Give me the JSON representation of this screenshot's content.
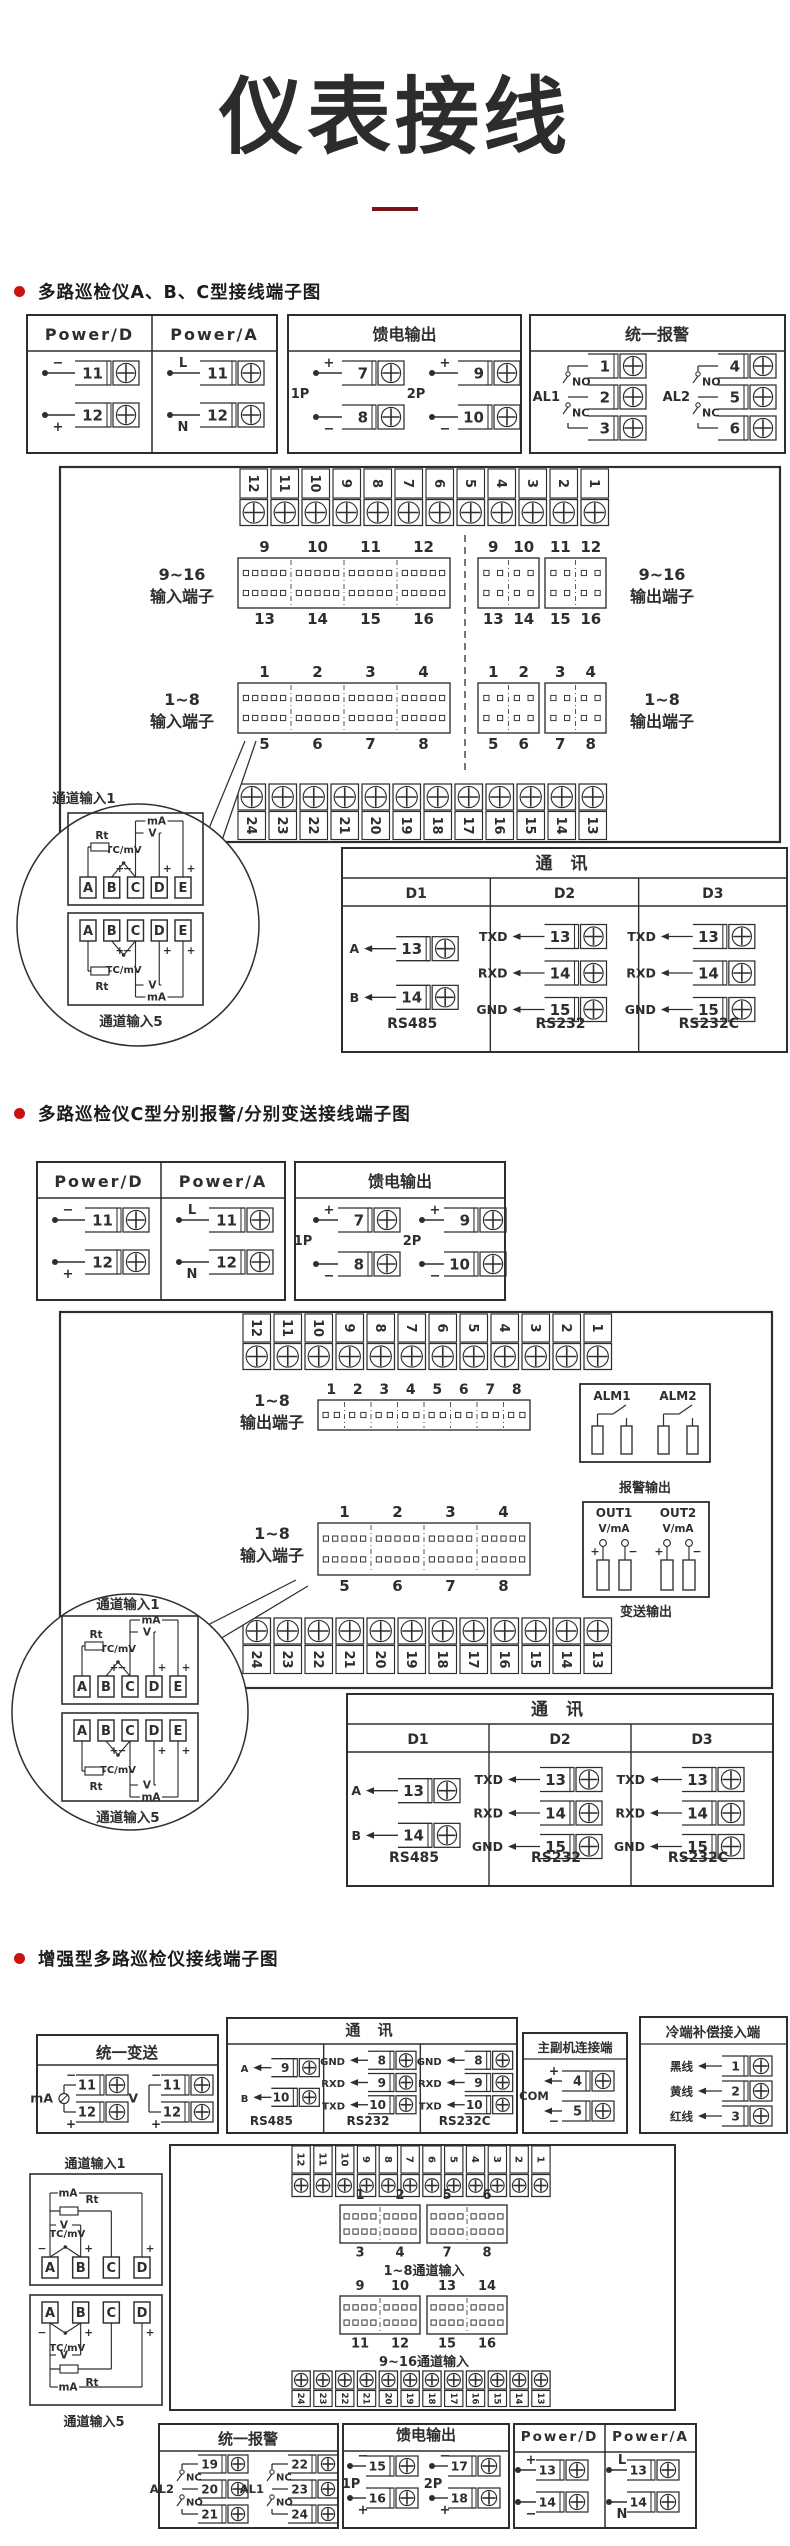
{
  "page": {
    "title": "仪表接线",
    "ink": "#2e2e2e",
    "bullet_color": "#cd1111",
    "underline_color": "#7d1418"
  },
  "headings": [
    "多路巡检仪A、B、C型接线端子图",
    "多路巡检仪C型分别报警/分别变送接线端子图",
    "增强型多路巡检仪接线端子图"
  ],
  "strings": {
    "power_d": "Power/D",
    "power_a": "Power/A",
    "feed_title": "馈电输出",
    "alarm_title": "统一报警",
    "transmit_title": "统一变送",
    "alarm_out": "报警输出",
    "transmit_out": "变送输出",
    "master_slave_title": "主副机连接端",
    "cold_title": "冷端补偿接入端",
    "com": "COM",
    "ch_in_1": "通道输入1",
    "ch_in_5": "通道输入5",
    "in916": [
      "9~16",
      "输入端子"
    ],
    "out916": [
      "9~16",
      "输出端子"
    ],
    "in18": [
      "1~8",
      "输入端子"
    ],
    "out18": [
      "1~8",
      "输出端子"
    ],
    "ch18": "1~8通道输入",
    "ch916": "9~16通道输入",
    "rt": "Rt",
    "tc": "TC/mV",
    "v": "V",
    "ma": "mA"
  },
  "strip12": [
    "12",
    "11",
    "10",
    "9",
    "8",
    "7",
    "6",
    "5",
    "4",
    "3",
    "2",
    "1"
  ],
  "strip24": [
    "24",
    "23",
    "22",
    "21",
    "20",
    "19",
    "18",
    "17",
    "16",
    "15",
    "14",
    "13"
  ],
  "section1": {
    "power_d_rows": [
      {
        "sign": "−",
        "pos": "above",
        "num": "11"
      },
      {
        "sign": "+",
        "pos": "below",
        "num": "12"
      }
    ],
    "power_a_rows": [
      {
        "sign": "L",
        "pos": "above",
        "num": "11"
      },
      {
        "sign": "N",
        "pos": "below",
        "num": "12"
      }
    ],
    "feed_groups": [
      {
        "label": "1P",
        "rows": [
          {
            "sign": "+",
            "pos": "above",
            "num": "7"
          },
          {
            "sign": "−",
            "pos": "below",
            "num": "8"
          }
        ]
      },
      {
        "label": "2P",
        "rows": [
          {
            "sign": "+",
            "pos": "above",
            "num": "9"
          },
          {
            "sign": "−",
            "pos": "below",
            "num": "10"
          }
        ]
      }
    ],
    "alarm_groups": [
      {
        "label": "AL1",
        "contacts": [
          "NO",
          "NC"
        ],
        "nums": [
          "1",
          "2",
          "3"
        ]
      },
      {
        "label": "AL2",
        "contacts": [
          "NO",
          "NC"
        ],
        "nums": [
          "4",
          "5",
          "6"
        ]
      }
    ],
    "in916_top": [
      "9",
      "10",
      "11",
      "12"
    ],
    "in916_bot": [
      "13",
      "14",
      "15",
      "16"
    ],
    "out916_top": [
      "9",
      "10",
      "11",
      "12"
    ],
    "out916_bot": [
      "13",
      "14",
      "15",
      "16"
    ],
    "in18_top": [
      "1",
      "2",
      "3",
      "4"
    ],
    "in18_bot": [
      "5",
      "6",
      "7",
      "8"
    ],
    "out18_top": [
      "1",
      "2",
      "3",
      "4"
    ],
    "out18_bot": [
      "5",
      "6",
      "7",
      "8"
    ],
    "comm": {
      "title": "通  讯",
      "headers": [
        "D1",
        "D2",
        "D3"
      ],
      "cols": [
        {
          "rows": [
            {
              "sig": "A",
              "num": "13"
            },
            {
              "sig": "B",
              "num": "14"
            }
          ],
          "type": "RS485"
        },
        {
          "rows": [
            {
              "sig": "TXD",
              "num": "13"
            },
            {
              "sig": "RXD",
              "num": "14"
            },
            {
              "sig": "GND",
              "num": "15"
            }
          ],
          "type": "RS232"
        },
        {
          "rows": [
            {
              "sig": "TXD",
              "num": "13"
            },
            {
              "sig": "RXD",
              "num": "14"
            },
            {
              "sig": "GND",
              "num": "15"
            }
          ],
          "type": "RS232C"
        }
      ]
    },
    "detail_terms": [
      "A",
      "B",
      "C",
      "D",
      "E"
    ]
  },
  "section2": {
    "power_d_rows": [
      {
        "sign": "−",
        "pos": "above",
        "num": "11"
      },
      {
        "sign": "+",
        "pos": "below",
        "num": "12"
      }
    ],
    "power_a_rows": [
      {
        "sign": "L",
        "pos": "above",
        "num": "11"
      },
      {
        "sign": "N",
        "pos": "below",
        "num": "12"
      }
    ],
    "feed_groups": [
      {
        "label": "1P",
        "rows": [
          {
            "sign": "+",
            "pos": "above",
            "num": "7"
          },
          {
            "sign": "−",
            "pos": "below",
            "num": "8"
          }
        ]
      },
      {
        "label": "2P",
        "rows": [
          {
            "sign": "+",
            "pos": "above",
            "num": "9"
          },
          {
            "sign": "−",
            "pos": "below",
            "num": "10"
          }
        ]
      }
    ],
    "out_row_nums": [
      "1",
      "2",
      "3",
      "4",
      "5",
      "6",
      "7",
      "8"
    ],
    "alm_labels": [
      "ALM1",
      "ALM2"
    ],
    "out_labels": [
      "OUT1",
      "OUT2"
    ],
    "out_sub": "V/mA",
    "out_signs": [
      "+",
      "−"
    ],
    "in18_top": [
      "1",
      "2",
      "3",
      "4"
    ],
    "in18_bot": [
      "5",
      "6",
      "7",
      "8"
    ],
    "comm": {
      "title": "通  讯",
      "headers": [
        "D1",
        "D2",
        "D3"
      ],
      "cols": [
        {
          "rows": [
            {
              "sig": "A",
              "num": "13"
            },
            {
              "sig": "B",
              "num": "14"
            }
          ],
          "type": "RS485"
        },
        {
          "rows": [
            {
              "sig": "TXD",
              "num": "13"
            },
            {
              "sig": "RXD",
              "num": "14"
            },
            {
              "sig": "GND",
              "num": "15"
            }
          ],
          "type": "RS232"
        },
        {
          "rows": [
            {
              "sig": "TXD",
              "num": "13"
            },
            {
              "sig": "RXD",
              "num": "14"
            },
            {
              "sig": "GND",
              "num": "15"
            }
          ],
          "type": "RS232C"
        }
      ]
    },
    "detail_terms": [
      "A",
      "B",
      "C",
      "D",
      "E"
    ]
  },
  "section3": {
    "transmit_groups": [
      {
        "label": "mA",
        "meter": true,
        "rows": [
          {
            "sign": "−",
            "num": "11"
          },
          {
            "sign": "+",
            "num": "12"
          }
        ]
      },
      {
        "label": "V",
        "meter": false,
        "rows": [
          {
            "sign": "−",
            "num": "11"
          },
          {
            "sign": "+",
            "num": "12"
          }
        ]
      }
    ],
    "comm": {
      "title": "通  讯",
      "headers": null,
      "cols": [
        {
          "rows": [
            {
              "sig": "A",
              "num": "9"
            },
            {
              "sig": "B",
              "num": "10"
            }
          ],
          "type": "RS485"
        },
        {
          "rows": [
            {
              "sig": "GND",
              "num": "8"
            },
            {
              "sig": "RXD",
              "num": "9"
            },
            {
              "sig": "TXD",
              "num": "10"
            }
          ],
          "type": "RS232"
        },
        {
          "rows": [
            {
              "sig": "GND",
              "num": "8"
            },
            {
              "sig": "RXD",
              "num": "9"
            },
            {
              "sig": "TXD",
              "num": "10"
            }
          ],
          "type": "RS232C"
        }
      ]
    },
    "master_label": "COM",
    "master_rows": [
      {
        "sign": "+",
        "pos": "above",
        "num": "4"
      },
      {
        "sign": "−",
        "pos": "below",
        "num": "5"
      }
    ],
    "cold_rows": [
      {
        "sig": "黑线",
        "num": "1"
      },
      {
        "sig": "黄线",
        "num": "2"
      },
      {
        "sig": "红线",
        "num": "3"
      }
    ],
    "detail_terms": [
      "A",
      "B",
      "C",
      "D"
    ],
    "blk18": {
      "rects": [
        {
          "top": [
            "1",
            "2"
          ],
          "bot": [
            "3",
            "4"
          ]
        },
        {
          "top": [
            "5",
            "6"
          ],
          "bot": [
            "7",
            "8"
          ]
        }
      ],
      "caption": "1~8通道输入"
    },
    "blk916": {
      "rects": [
        {
          "top": [
            "9",
            "10"
          ],
          "bot": [
            "11",
            "12"
          ]
        },
        {
          "top": [
            "13",
            "14"
          ],
          "bot": [
            "15",
            "16"
          ]
        }
      ],
      "caption": "9~16通道输入"
    },
    "alarm_groups": [
      {
        "label": "AL2",
        "contacts": [
          "NC",
          "NO"
        ],
        "nums": [
          "19",
          "20",
          "21"
        ]
      },
      {
        "label": "AL1",
        "contacts": [
          "NC",
          "NO"
        ],
        "nums": [
          "22",
          "23",
          "24"
        ]
      }
    ],
    "feed_groups": [
      {
        "label": "1P",
        "rows": [
          {
            "sign": "−",
            "pos": "above",
            "num": "15"
          },
          {
            "sign": "+",
            "pos": "below",
            "num": "16"
          }
        ]
      },
      {
        "label": "2P",
        "rows": [
          {
            "sign": "−",
            "pos": "above",
            "num": "17"
          },
          {
            "sign": "+",
            "pos": "below",
            "num": "18"
          }
        ]
      }
    ],
    "power_d_rows": [
      {
        "sign": "+",
        "pos": "above",
        "num": "13"
      },
      {
        "sign": "−",
        "pos": "below",
        "num": "14"
      }
    ],
    "power_a_rows": [
      {
        "sign": "L",
        "pos": "above",
        "num": "13"
      },
      {
        "sign": "N",
        "pos": "below",
        "num": "14"
      }
    ]
  }
}
